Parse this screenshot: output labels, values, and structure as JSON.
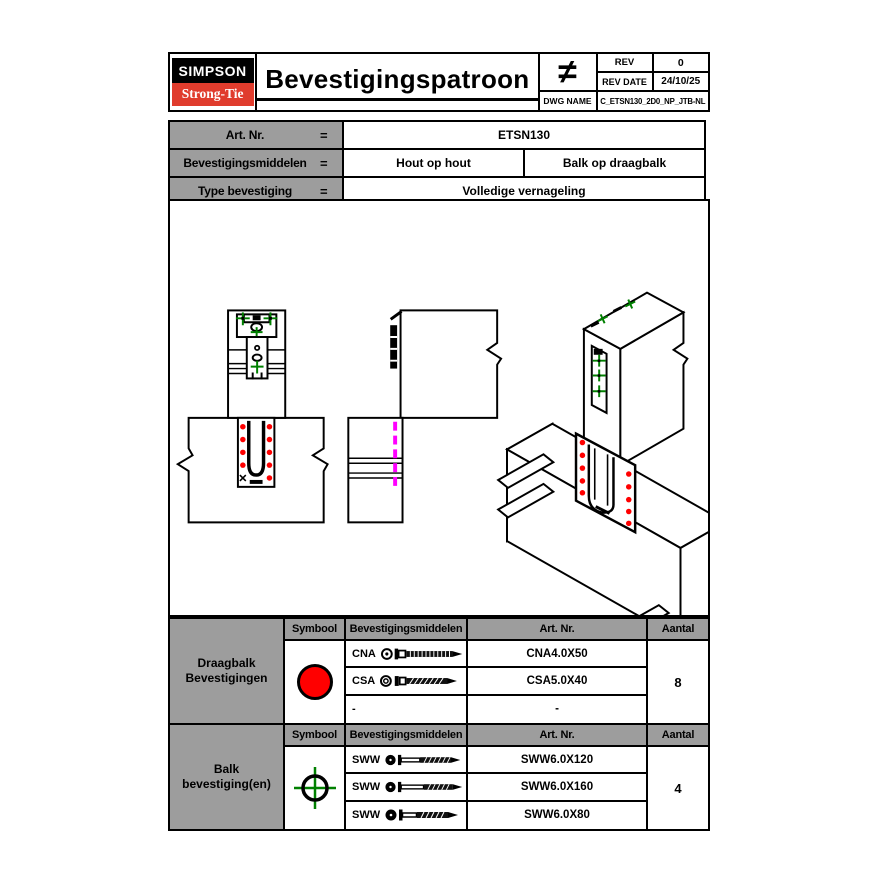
{
  "colors": {
    "brand_red": "#E03C2D",
    "symbol_red": "#FF0000",
    "symbol_green": "#008000",
    "hidden_line_magenta": "#FF00FF",
    "table_header_gray": "#9d9d9d"
  },
  "header": {
    "logo": {
      "line1": "SIMPSON",
      "line2": "Strong-Tie"
    },
    "title": "Bevestigingspatroon",
    "neq_symbol": "≠",
    "rev_label": "REV",
    "rev_value": "0",
    "rev_date_label": "REV DATE",
    "rev_date_value": "24/10/25",
    "dwg_name_label": "DWG NAME",
    "dwg_name_value": "C_ETSN130_2D0_NP_JTB-NL"
  },
  "info": {
    "rows": [
      {
        "label": "Art. Nr.",
        "eq": "=",
        "values": [
          "ETSN130"
        ]
      },
      {
        "label": "Bevestigingsmiddelen",
        "eq": "=",
        "values": [
          "Hout op hout",
          "Balk op draagbalk"
        ]
      },
      {
        "label": "Type bevestiging",
        "eq": "=",
        "values": [
          "Volledige vernageling"
        ]
      }
    ]
  },
  "drawings": {
    "views": [
      "front-view",
      "side-view",
      "isometric-view"
    ],
    "symbols": [
      "red-nail-dot",
      "green-screw-crosshair",
      "magenta-hidden-line"
    ]
  },
  "fastener_tables": [
    {
      "title": "Draagbalk Bevestigingen",
      "headers": [
        "Symbool",
        "Bevestigingsmiddelen",
        "Art. Nr.",
        "Aantal"
      ],
      "symbol": "red-circle",
      "rows": [
        {
          "icon": "ring-nail",
          "label": "CNA",
          "art_nr": "CNA4.0X50"
        },
        {
          "icon": "screw",
          "label": "CSA",
          "art_nr": "CSA5.0X40"
        },
        {
          "icon": "none",
          "label": "-",
          "art_nr": "-"
        }
      ],
      "aantal": "8"
    },
    {
      "title": "Balk bevestiging(en)",
      "headers": [
        "Symbool",
        "Bevestigingsmiddelen",
        "Art. Nr.",
        "Aantal"
      ],
      "symbol": "green-crosshair",
      "rows": [
        {
          "icon": "long-screw",
          "label": "SWW",
          "art_nr": "SWW6.0X120"
        },
        {
          "icon": "long-screw",
          "label": "SWW",
          "art_nr": "SWW6.0X160"
        },
        {
          "icon": "long-screw",
          "label": "SWW",
          "art_nr": "SWW6.0X80"
        }
      ],
      "aantal": "4"
    }
  ]
}
